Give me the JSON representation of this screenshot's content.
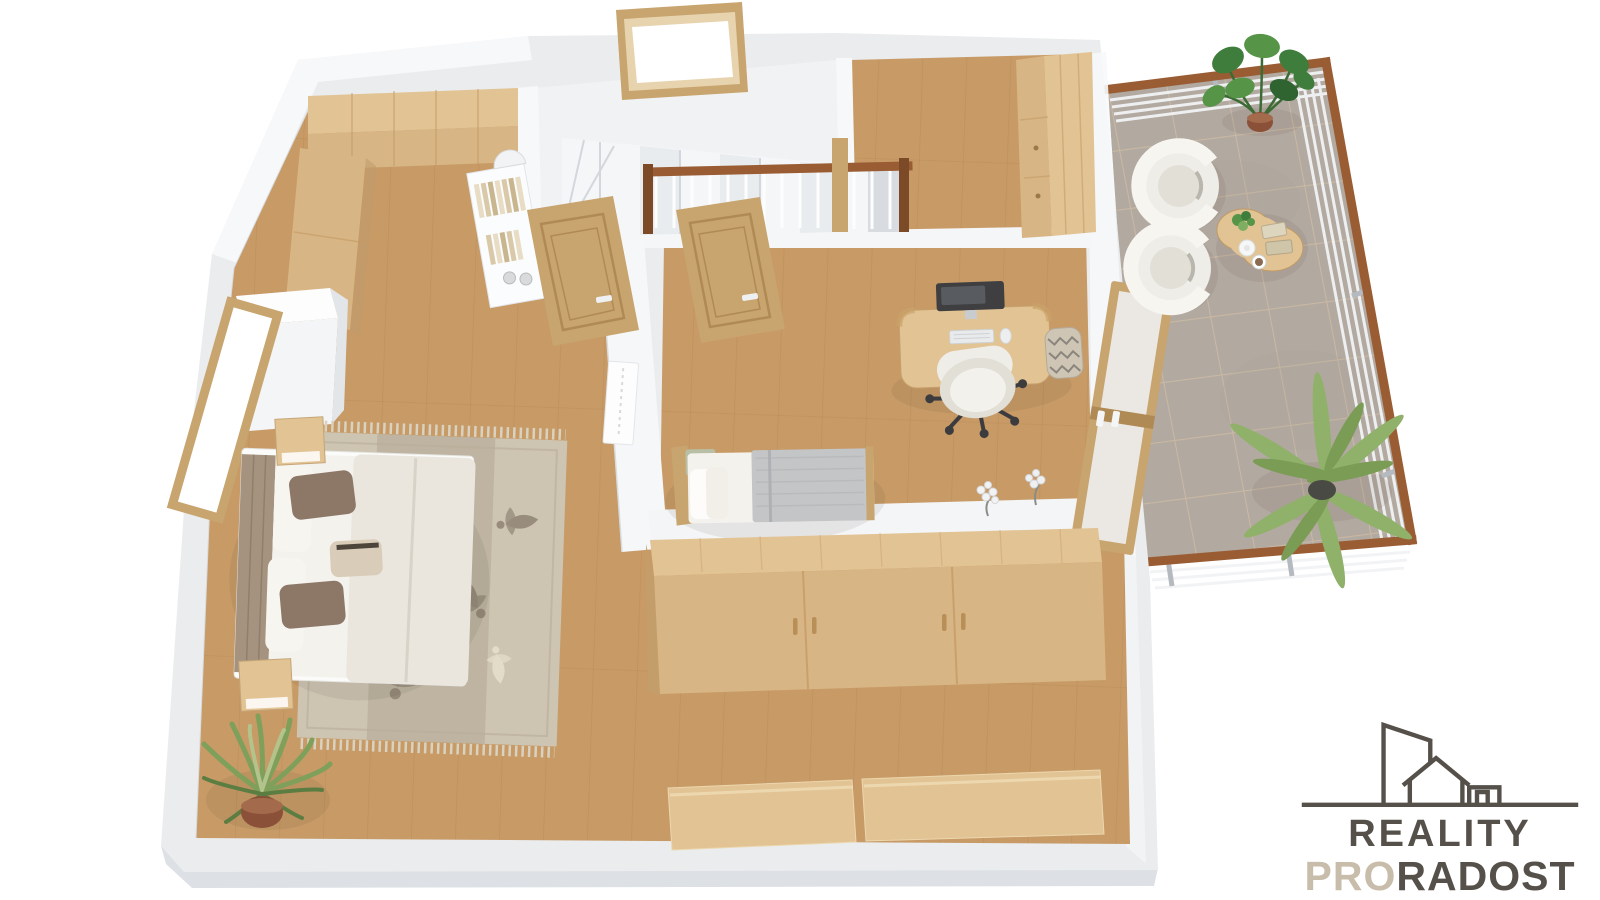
{
  "meta": {
    "description": "3D rendered top-down floor plan of an attic apartment with terrace",
    "background": "#ffffff"
  },
  "palette": {
    "wall-face": "#eaecee",
    "wall-top": "#f7f8fa",
    "wall-shade": "#dcdfe2",
    "hall-floor": "#f1f2f4",
    "floor-wood": "#c79a66",
    "plank-line": "#b4854f",
    "tile": "#b2a9a0",
    "tile-grout": "#cdbba4",
    "wood-light": "#e2c394",
    "wood-mid": "#d8b584",
    "wood-dark": "#c49a64",
    "door-wood": "#c8a46e",
    "rail-wood": "#9a5c33",
    "rug-base": "#cdc4b2",
    "rug-band": "#b3a793",
    "rug-motif": "#8f8373",
    "rug-cream": "#e6dfcb",
    "bedding-white": "#f4f2ed",
    "duvet": "#eae6de",
    "pillow-brown": "#8d7868",
    "pillow-cream": "#d9cdb9",
    "headboard": "#a5937f",
    "blanket-gray": "#c4c5c7",
    "chair-white": "#efede7",
    "chair-inner": "#e2dfd7",
    "metal-dark": "#3c3c3e",
    "plant-dark": "#3f7d3c",
    "plant-mid": "#569447",
    "plant-palm": "#8fb169",
    "plant-blade": "#7fa05a",
    "pot-terracotta": "#8a5038",
    "pot-dark": "#4a4a44",
    "basket": "#cfc5b4",
    "logo-dark": "#55504a",
    "logo-beige": "#c8bdab"
  },
  "logo": {
    "line1": "REALITY",
    "line2_accent": "PRO",
    "line2_rest": "RADOST"
  },
  "scene": {
    "rooms": [
      {
        "name": "master-bedroom",
        "furniture": [
          "double-bed",
          "nightstand",
          "nightstand",
          "area-rug",
          "built-in-wardrobe",
          "window",
          "potted-plant",
          "bookshelf",
          "wall-panel"
        ]
      },
      {
        "name": "hallway",
        "furniture": [
          "staircase",
          "stair-railing",
          "skylight-window",
          "wooden-door",
          "wooden-door"
        ]
      },
      {
        "name": "walk-in-closet",
        "furniture": [
          "wardrobe",
          "tall-cabinet"
        ]
      },
      {
        "name": "bedroom",
        "furniture": [
          "single-bed",
          "desk",
          "computer-monitor",
          "keyboard",
          "mouse",
          "office-chair",
          "storage-basket",
          "terrace-door",
          "flower-decoration"
        ]
      },
      {
        "name": "dressing-area",
        "furniture": [
          "sliding-wardrobe",
          "storage-bench"
        ]
      },
      {
        "name": "terrace",
        "furniture": [
          "swivel-armchair",
          "swivel-armchair",
          "coffee-table",
          "teapot",
          "books",
          "monstera-plant",
          "palm-plant",
          "wood-railing",
          "tile-floor"
        ]
      }
    ]
  }
}
